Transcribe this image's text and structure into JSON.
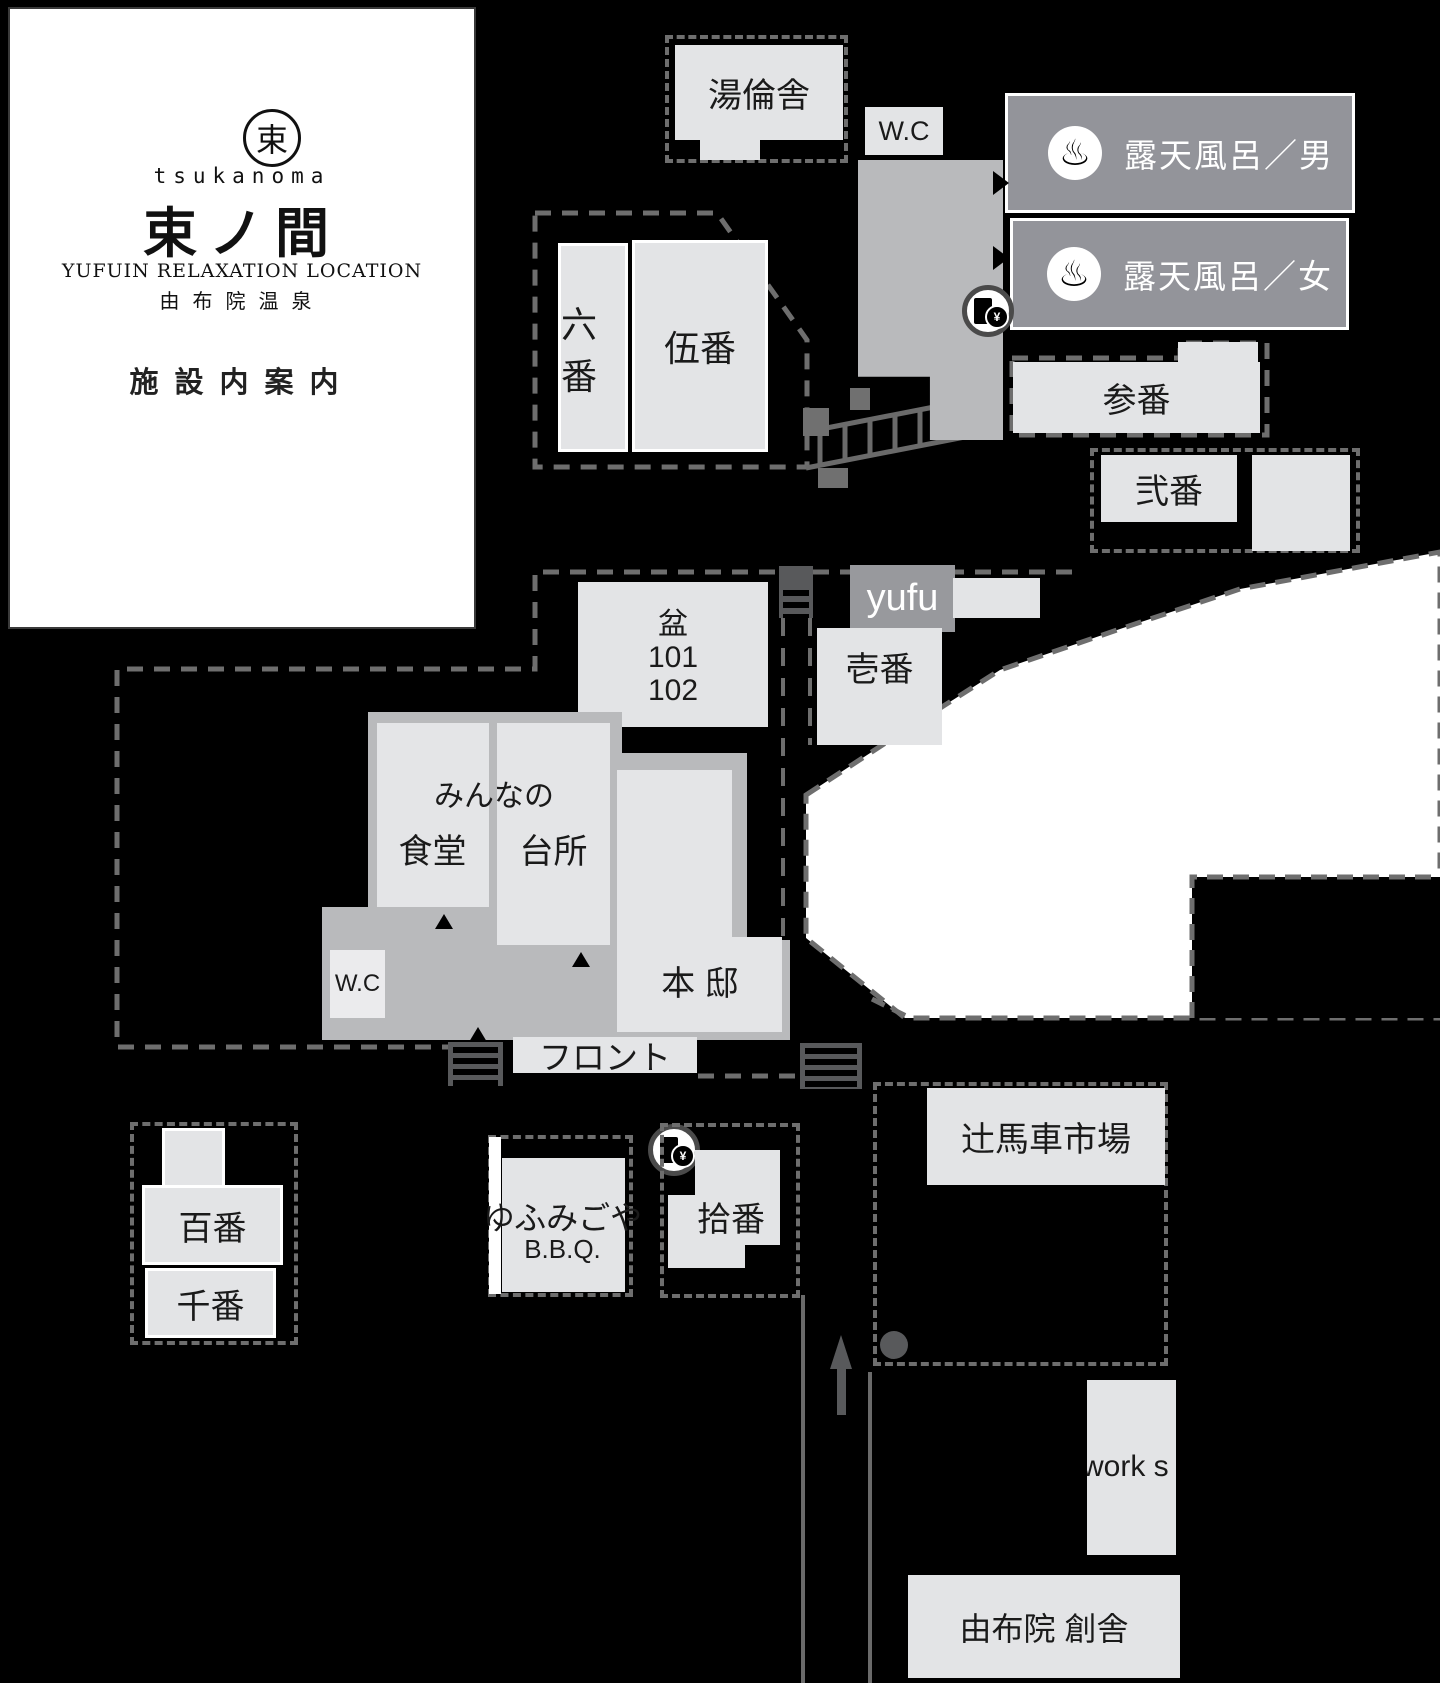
{
  "canvas": {
    "width": 1440,
    "height": 1683,
    "background": "#000000"
  },
  "palette": {
    "building_light": "#e3e4e6",
    "building_mid": "#b9babc",
    "label_box_gray": "#93949a",
    "dash_gray": "#6e6e6e",
    "river_white": "#ffffff",
    "dark_gray": "#58595b",
    "text_dark": "#1a1a1a",
    "text_white": "#ffffff"
  },
  "logo": {
    "emblem_char": "束",
    "brand_roman": "tsukanoma",
    "brand_kanji": "束ノ間",
    "subtitle_en": "YUFUIN  RELAXATION  LOCATION",
    "subtitle_jp": "由布院温泉",
    "map_title": "施設内案内"
  },
  "open_air_baths": {
    "men": {
      "icon": "♨",
      "label": "露天風呂／男"
    },
    "women": {
      "icon": "♨",
      "label": "露天風呂／女"
    }
  },
  "icons": {
    "hot_spring": "♨",
    "ticket_yen": "¥"
  },
  "buildings": {
    "yurinsha": "湯倫舎",
    "wc_top": "W.C",
    "rokuban": "六番",
    "goban": "伍番",
    "sanban": "参番",
    "niban": "弐番",
    "ichiban": "壱番",
    "yufu": "yufu",
    "bon": "盆",
    "bon_room1": "101",
    "bon_room2": "102",
    "minna_no": "みんなの",
    "shokudo": "食堂",
    "daidokoro": "台所",
    "wc_main": "W.C",
    "hontei": "本 邸",
    "front": "フロント",
    "hyakuban": "百番",
    "senban": "千番",
    "yufumigoya": "ゆふみごや",
    "bbq": "B.B.Q.",
    "juban": "拾番",
    "tsujibasha": "辻馬車市場",
    "workshop": "work s",
    "sosha": "由布院 創舎"
  }
}
